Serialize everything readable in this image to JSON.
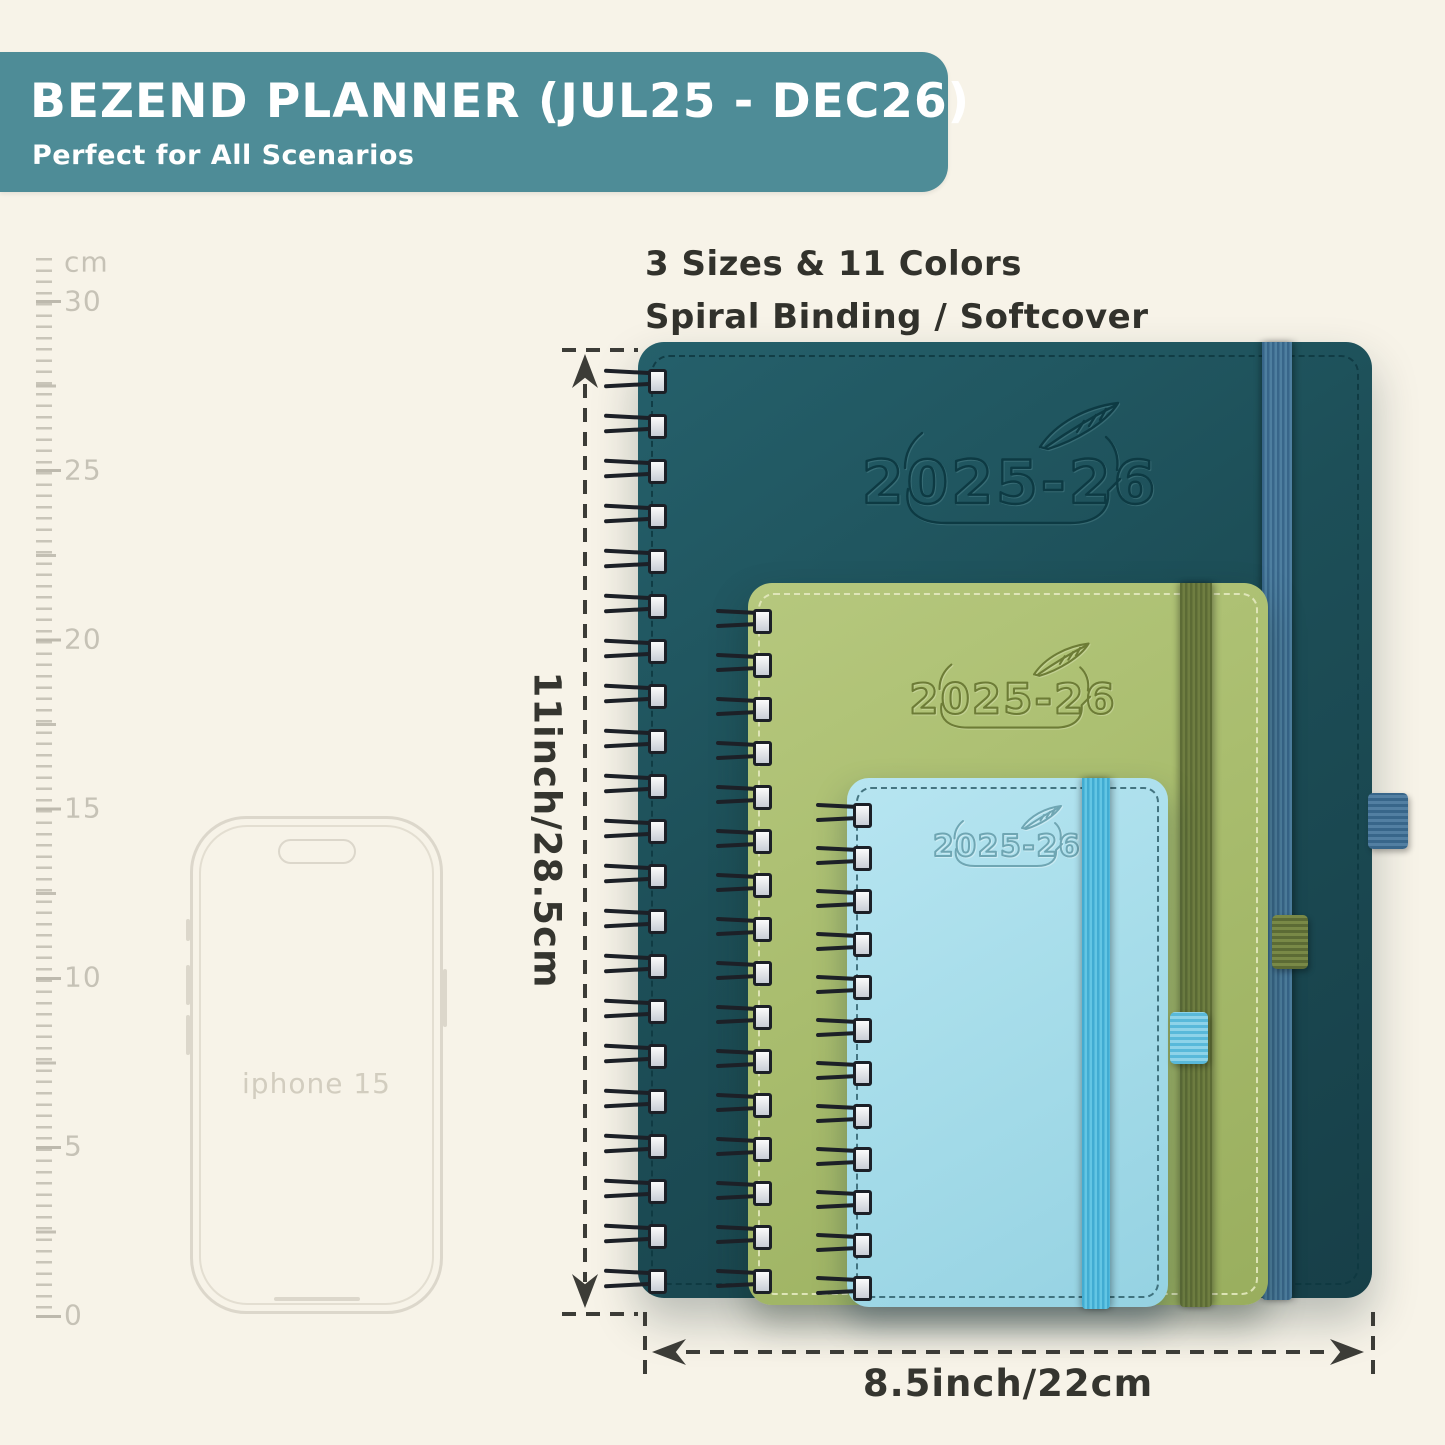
{
  "banner": {
    "title": "BEZEND PLANNER (JUL25 - DEC26)",
    "subtitle": "Perfect for All Scenarios",
    "bg_color": "#4e8c97",
    "text_color": "#ffffff"
  },
  "features": {
    "line1": "3 Sizes & 11 Colors",
    "line2": "Spiral Binding / Softcover"
  },
  "ruler": {
    "unit": "cm",
    "labels": [
      "cm",
      "30",
      "25",
      "20",
      "15",
      "10",
      "5",
      "0"
    ],
    "tick_color": "#c6c2b6"
  },
  "phone": {
    "label": "iphone 15",
    "outline_color": "#dcd7cb"
  },
  "planners": [
    {
      "size_name": "large",
      "cover_text": "2025-26",
      "cover_color": "#1d4f58",
      "band_color": "#41718f",
      "binding": "spiral"
    },
    {
      "size_name": "medium",
      "cover_text": "2025-26",
      "cover_color": "#a9bd6e",
      "band_color": "#66753c",
      "binding": "spiral"
    },
    {
      "size_name": "small",
      "cover_text": "2025-26",
      "cover_color": "#a7ddea",
      "band_color": "#4fb9dd",
      "binding": "spiral"
    }
  ],
  "dimensions": {
    "height_label": "11inch/28.5cm",
    "width_label": "8.5inch/22cm"
  }
}
